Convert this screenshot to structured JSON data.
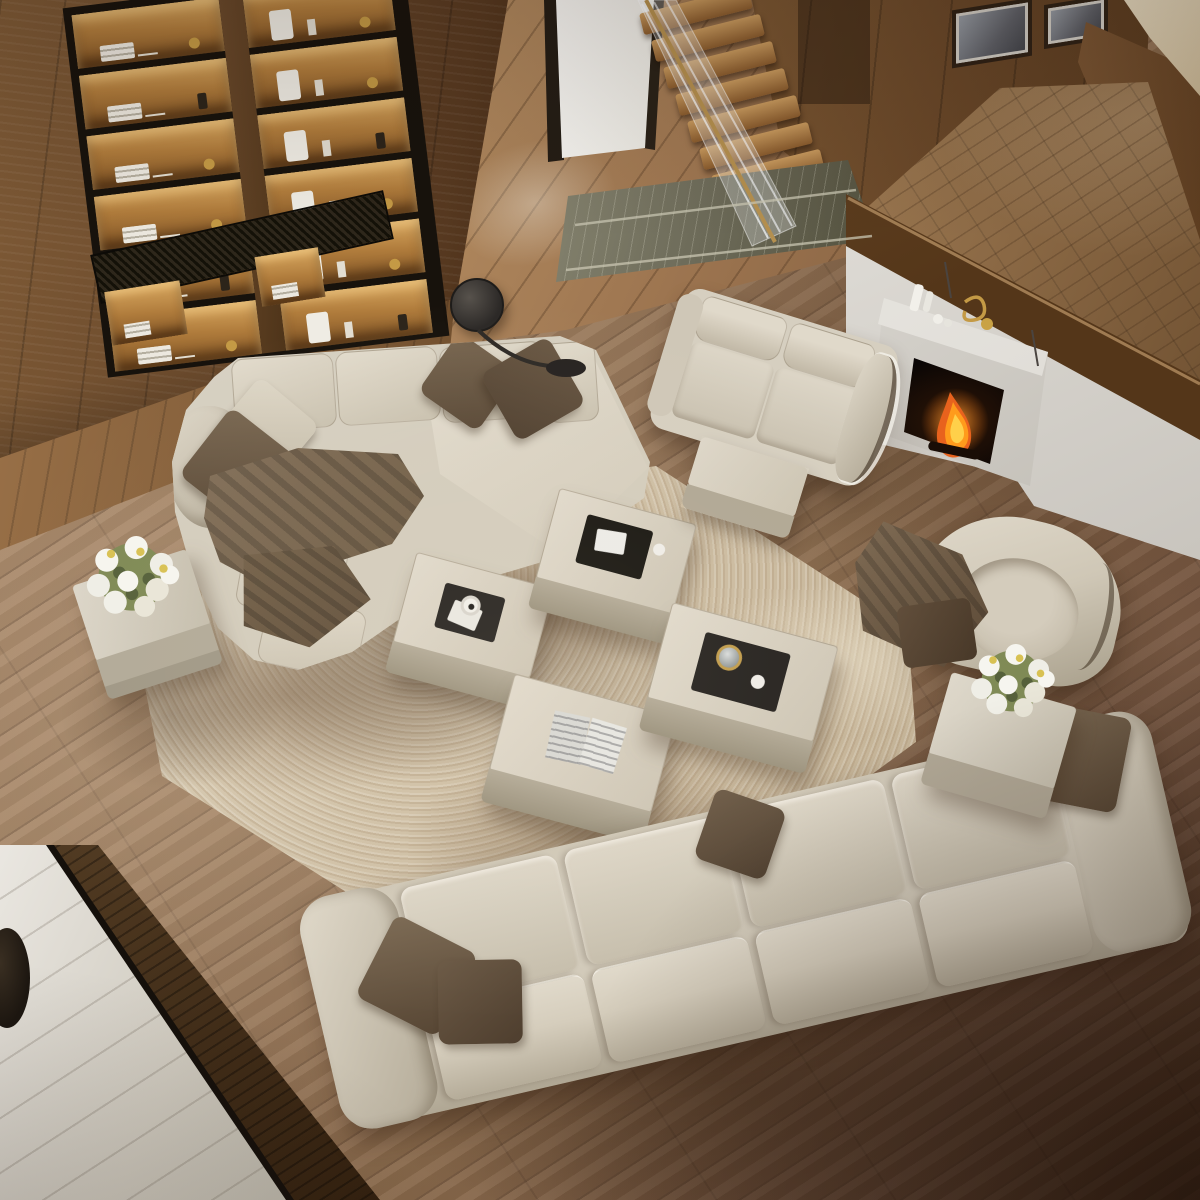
{
  "meta": {
    "type": "natural-image",
    "description": "Top-down 3D render of a double-height modern living room: cream leather modular sofa set around ottoman coffee tables on a shag rug, wood plank floor, backlit shelving wall, floating staircase, and a white fireplace half-wall with burning fire."
  },
  "palette": {
    "floor_wood": "#96765a",
    "floor_wood_dark": "#64462f",
    "wall_walnut": "#6b4a2c",
    "shelf_glow": "#c9913f",
    "doorway_light": "#f6f5f1",
    "stair_tread": "#9c6f3c",
    "marble_step": "#6e6c5a",
    "landing_parquet": "#8a6844",
    "pony_wall_white": "#ece9e5",
    "walnut_cap": "#543619",
    "fire_orange": "#ff9b1c",
    "sofa_cream": "#d6cfc0",
    "sofa_shadow": "#b0a794",
    "pillow_brown": "#6d5b46",
    "throw_taupe": "#7b6a52",
    "rug_cream": "#d9cdb6",
    "rug_marble": "#a08a6e",
    "tray_black": "#23201d",
    "brass": "#c9a245",
    "marble_floor": "#e9e6e0"
  },
  "scene": {
    "room": {
      "label": "double-height living room seen from above"
    },
    "objects": {
      "wood_floor": {
        "label": "oak plank flooring",
        "color": "#96765a"
      },
      "panel_wall": {
        "label": "walnut panel wall",
        "color": "#6b4a2c"
      },
      "bookshelf": {
        "label": "backlit built-in shelving with books, vases and sculptures",
        "color": "#c9913f"
      },
      "media_grille": {
        "label": "slatted media panel under shelving"
      },
      "doorway": {
        "label": "bright open doorway",
        "color": "#f6f5f1"
      },
      "staircase": {
        "label": "floating wood staircase",
        "color": "#9c6f3c"
      },
      "glass_railing": {
        "label": "glass and brass stair railing"
      },
      "marble_steps": {
        "label": "marble entry steps",
        "color": "#6e6c5a"
      },
      "upper_landing": {
        "label": "raised parquet landing",
        "color": "#8a6844"
      },
      "artworks": {
        "label": "two framed artworks on landing wall"
      },
      "accent_wall_cream": {
        "label": "cream accent wall",
        "color": "#d9cdb2"
      },
      "pony_wall": {
        "label": "white half wall with walnut cap",
        "color": "#ece9e5"
      },
      "fireplace": {
        "label": "white mantel fireplace",
        "color": "#f1efeb"
      },
      "fire": {
        "label": "burning fire in firebox",
        "color": "#ff9b1c"
      },
      "mantel_decor": {
        "label": "white bottles, cups and brass ornament on mantel shelf"
      },
      "loveseat": {
        "label": "cream leather loveseat",
        "color": "#d6cfc0"
      },
      "loveseat_ottoman": {
        "label": "cream ottoman beside loveseat"
      },
      "sectional_sofa": {
        "label": "cream modular sectional sofa with wide chaise"
      },
      "throw_blanket": {
        "label": "taupe throw blanket draped over sectional",
        "color": "#7b6a52"
      },
      "accent_pillows": {
        "label": "brown accent pillows",
        "color": "#6d5b46"
      },
      "sofa": {
        "label": "cream three-seat sofa with brown pillows"
      },
      "armchair": {
        "label": "cream swivel armchair"
      },
      "armchair_throw": {
        "label": "brown throw over armchair",
        "color": "#5a4835"
      },
      "shag_rug": {
        "label": "cream shag rug with taupe marbling",
        "color": "#d9cdb6"
      },
      "ottoman_table_cup": {
        "label": "ottoman coffee table with tray and white mug"
      },
      "ottoman_table_book": {
        "label": "ottoman coffee table with black book"
      },
      "ottoman_table_magazine": {
        "label": "ottoman coffee table with open magazine"
      },
      "ottoman_table_tray": {
        "label": "ottoman coffee table with serving tray and glass jar"
      },
      "side_table_left": {
        "label": "cube side table with white bouquet"
      },
      "side_table_right": {
        "label": "cube side table with white bouquet"
      },
      "bouquet": {
        "label": "white flower bouquet"
      },
      "floor_lamp": {
        "label": "black arc floor lamp"
      },
      "marble_inlay_floor": {
        "label": "marble floor with walnut inlay border"
      }
    }
  }
}
